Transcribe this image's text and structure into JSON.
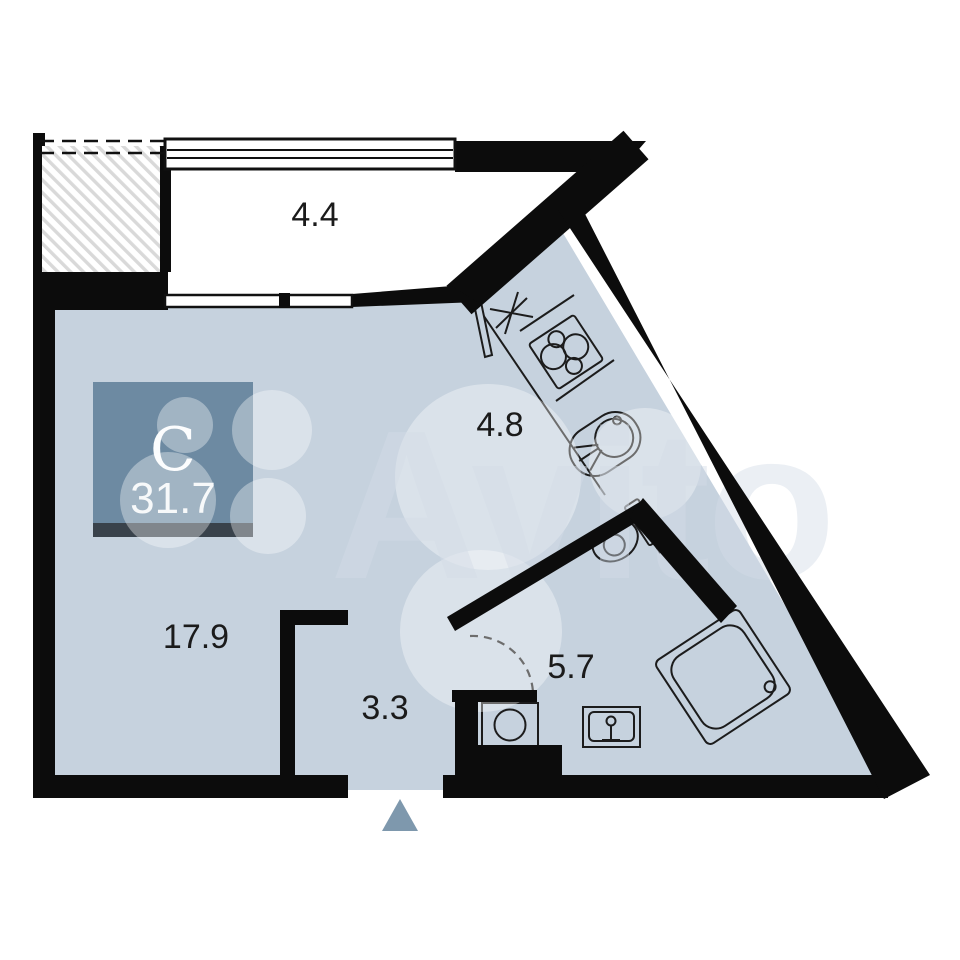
{
  "floorplan": {
    "title": "studio apartment floor plan",
    "unit_badge": {
      "type_letter": "С",
      "total_area": "31.7"
    },
    "rooms": [
      {
        "id": "balcony",
        "area": "4.4"
      },
      {
        "id": "kitchen",
        "area": "4.8"
      },
      {
        "id": "living-room",
        "area": "17.9"
      },
      {
        "id": "hallway",
        "area": "3.3"
      },
      {
        "id": "bathroom",
        "area": "5.7"
      }
    ],
    "fixtures": [
      "cooktop",
      "kitchen-sink",
      "vent-asterisk",
      "balcony-door",
      "toilet",
      "shower-cabin",
      "washing-machine",
      "bathroom-sink",
      "bathroom-door-swing",
      "entrance-arrow"
    ],
    "watermark": "Avito",
    "colors": {
      "floor": "#c6d2de",
      "wall": "#0c0c0c",
      "badge": "#6d8aa2",
      "badge_bar": "#39424b",
      "entrance_arrow": "#7e98ad",
      "hatch_line": "#d9d9d9"
    }
  }
}
